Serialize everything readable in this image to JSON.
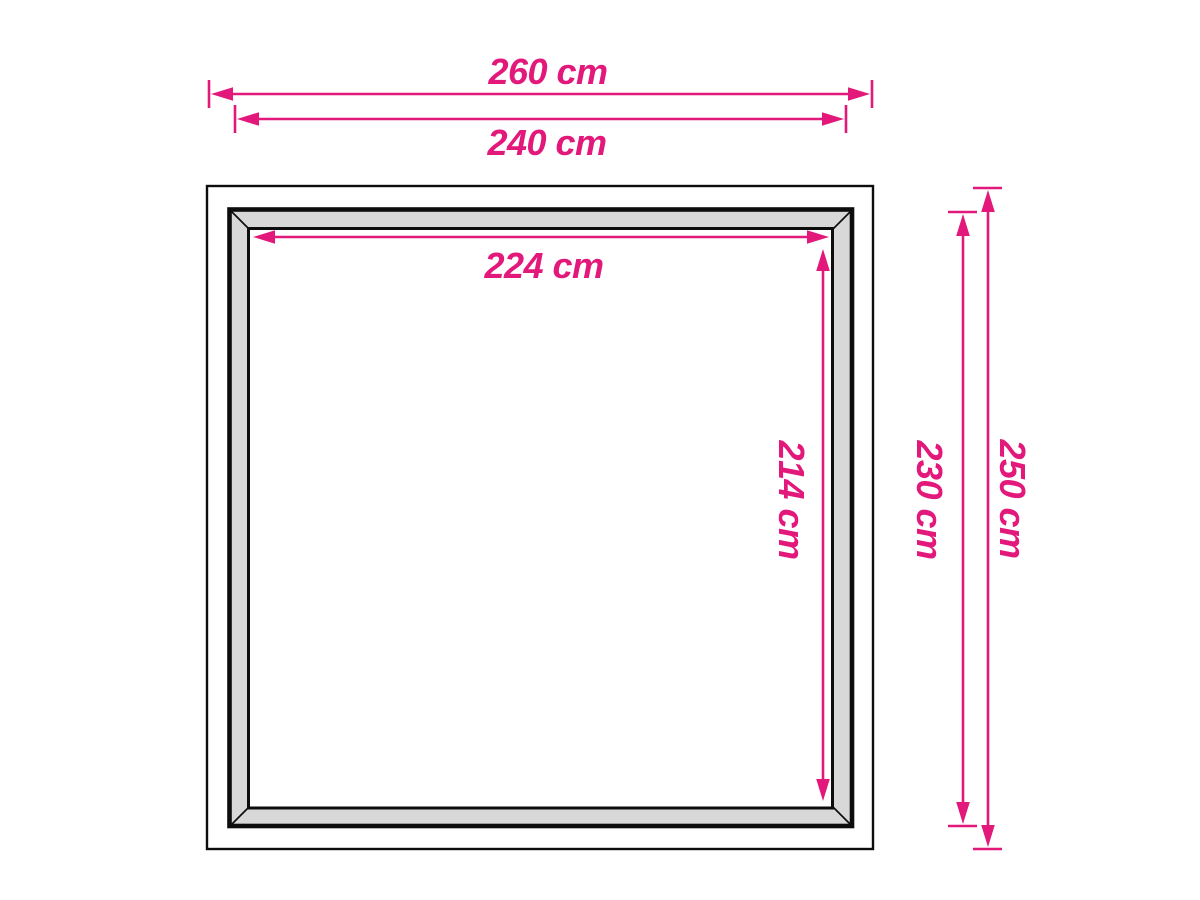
{
  "diagram": {
    "unit": "cm",
    "labels": {
      "outer_width": "260 cm",
      "frame_width": "240 cm",
      "opening_width": "224 cm",
      "opening_height": "214 cm",
      "frame_height": "230 cm",
      "outer_height": "250 cm"
    },
    "values": {
      "outer_width": 260,
      "frame_width": 240,
      "opening_width": 224,
      "opening_height": 214,
      "frame_height": 230,
      "outer_height": 250
    },
    "colors": {
      "dimension_pink": "#e3187b",
      "frame_fill": "#d8d8d8",
      "outline_black": "#0d0d0d",
      "background": "#ffffff"
    }
  }
}
